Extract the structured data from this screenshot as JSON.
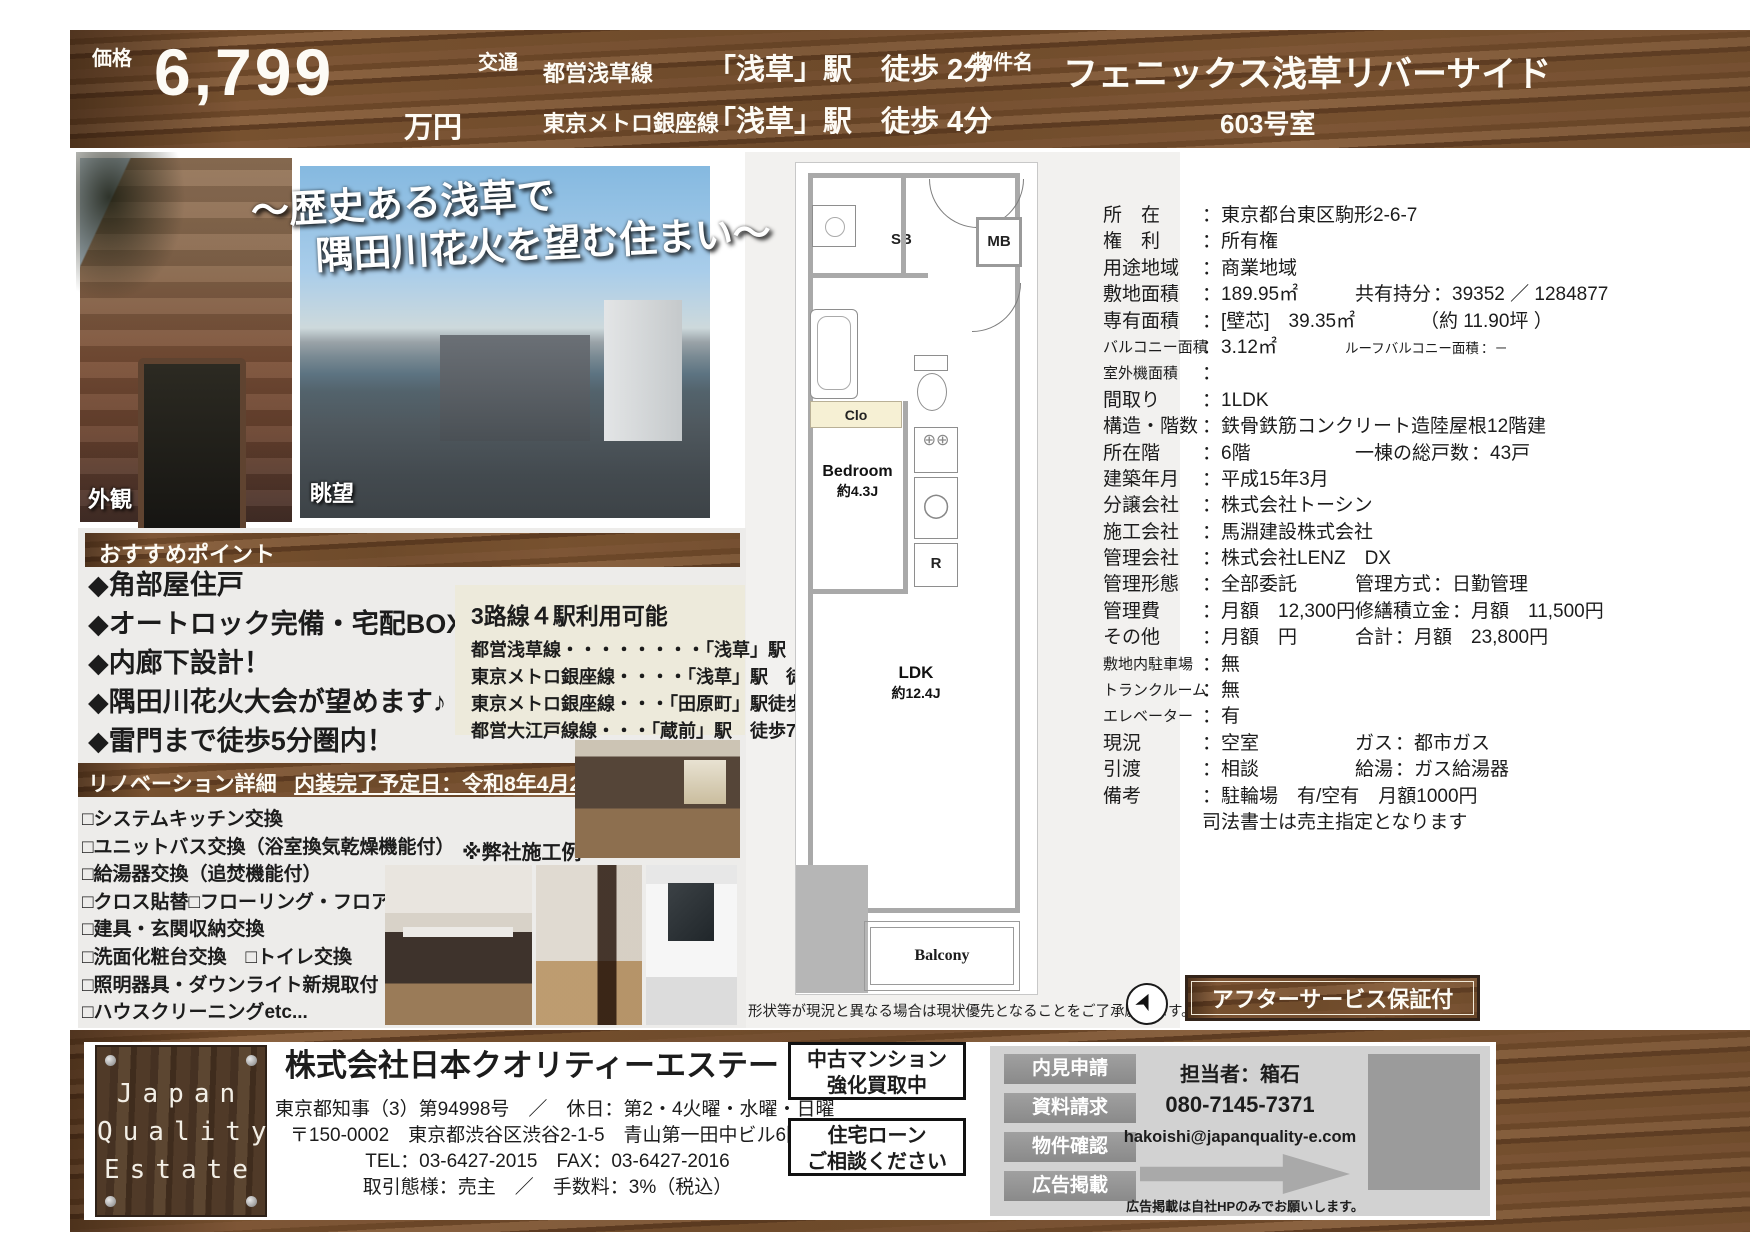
{
  "header": {
    "price_label": "価格",
    "price_value": "6,799",
    "price_unit": "万円",
    "transit_label": "交通",
    "transit": [
      {
        "line": "都営浅草線",
        "dest": "「浅草」駅　徒歩 2分"
      },
      {
        "line": "東京メトロ銀座線",
        "dest": "「浅草」駅　徒歩 4分"
      }
    ],
    "property_label": "物件名",
    "property_name": "フェニックス浅草リバーサイド",
    "room": "603号室"
  },
  "photos": {
    "exterior_label": "外観",
    "view_label": "眺望",
    "catch1": "〜歴史ある浅草で",
    "catch2": "隅田川花火を望む住まい〜"
  },
  "points": {
    "title": "おすすめポイント",
    "items": [
      "◆角部屋住戸",
      "◆オートロック完備・宅配BOX有",
      "◆内廊下設計！",
      "◆隅田川花火大会が望めます♪",
      "◆雷門まで徒歩5分圏内！"
    ]
  },
  "access": {
    "title": "3路線４駅利用可能",
    "items": [
      "都営浅草線・・・・・・・・「浅草」駅　徒歩2分",
      "東京メトロ銀座線・・・・「浅草」駅　徒歩4分",
      "東京メトロ銀座線・・・「田原町」駅徒歩9分",
      "都営大江戸線線・・・「蔵前」駅　徒歩7分"
    ]
  },
  "renovation": {
    "title": "リノベーション詳細",
    "schedule": "内装完了予定日：令和8年4月20日",
    "items": [
      "□システムキッチン交換",
      "□ユニットバス交換（浴室換気乾燥機能付）",
      "□給湯器交換（追焚機能付）",
      "□クロス貼替□フローリング・フロアタイル貼替",
      "□建具・玄関収納交換",
      "□洗面化粧台交換　□トイレ交換",
      "□照明器具・ダウンライト新規取付",
      "□ハウスクリーニングetc..."
    ],
    "example_note": "※弊社施工例"
  },
  "floorplan": {
    "sb": "SB",
    "mb": "MB",
    "clo": "Clo",
    "bedroom": "Bedroom",
    "bedroom_size": "約4.3J",
    "r": "R",
    "stove": "⊕⊕",
    "sink": "◯",
    "ldk": "LDK",
    "ldk_size": "約12.4J",
    "balcony": "Balcony",
    "note": "形状等が現況と異なる場合は現状優先となることをご了承願います。",
    "compass_glyph": "➤"
  },
  "details": {
    "rows": [
      {
        "l": "所　在",
        "v": "：東京都台東区駒形2-6-7"
      },
      {
        "l": "権　利",
        "v": "：所有権"
      },
      {
        "l": "用途地域",
        "v": "：商業地域"
      },
      {
        "l": "敷地面積",
        "v": "：189.95㎡",
        "l2": "共有持分",
        "v2": "：39352 ／ 1284877"
      },
      {
        "l": "専有面積",
        "v": "：[壁芯]　39.35㎡",
        "v2": "（約 11.90坪 ）"
      },
      {
        "l": "バルコニー面積",
        "v": "：3.12㎡",
        "l2": "ルーフバルコニー面積",
        "v2": "：－"
      },
      {
        "l": "室外機面積",
        "v": "："
      },
      {
        "l": "間取り",
        "v": "：1LDK"
      },
      {
        "l": "構造・階数",
        "v": "：鉄骨鉄筋コンクリート造陸屋根12階建"
      },
      {
        "l": "所在階",
        "v": "：6階",
        "l2": "一棟の総戸数",
        "v2": "：43戸"
      },
      {
        "l": "建築年月",
        "v": "：平成15年3月"
      },
      {
        "l": "分譲会社",
        "v": "：株式会社トーシン"
      },
      {
        "l": "施工会社",
        "v": "：馬淵建設株式会社"
      },
      {
        "l": "管理会社",
        "v": "：株式会社LENZ　DX"
      },
      {
        "l": "管理形態",
        "v": "：全部委託",
        "l2": "管理方式",
        "v2": "：日勤管理"
      },
      {
        "l": "管理費",
        "v": "：月額　12,300円",
        "l2": "修繕積立金",
        "v2": "：月額　11,500円"
      },
      {
        "l": "その他",
        "v": "：月額　円",
        "l2": "合計",
        "v2": "：月額　23,800円"
      },
      {
        "l": "敷地内駐車場",
        "v": "：無"
      },
      {
        "l": "トランクルーム",
        "v": "：無"
      },
      {
        "l": "エレベーター",
        "v": "：有"
      },
      {
        "l": "現況",
        "v": "：空室",
        "l2": "ガス",
        "v2": "：都市ガス"
      },
      {
        "l": "引渡",
        "v": "：相談",
        "l2": "給湯",
        "v2": "：ガス給湯器"
      },
      {
        "l": "備考",
        "v": "：駐輪場　有/空有　月額1000円"
      },
      {
        "l": "",
        "v": "司法書士は売主指定となります"
      }
    ]
  },
  "after_service": "アフターサービス保証付",
  "footer": {
    "logo_lines": [
      "Japan",
      "Quality",
      "Estate"
    ],
    "company": "株式会社日本クオリティーエステート",
    "license": "東京都知事（3）第94998号　／　休日：第2・4火曜・水曜・日曜",
    "address": "〒150-0002　東京都渋谷区渋谷2-1-5　青山第一田中ビル6階",
    "tel": "TEL：03-6427-2015　FAX：03-6427-2016",
    "terms": "取引態様：売主　／　手数料：3%（税込）",
    "box1_line1": "中古マンション",
    "box1_line2": "強化買取中",
    "box2_line1": "住宅ローン",
    "box2_line2": "ご相談ください",
    "buttons": [
      "内見申請",
      "資料請求",
      "物件確認",
      "広告掲載"
    ],
    "person": "担当者：箱石",
    "phone": "080-7145-7371",
    "email": "hakoishi@japanquality-e.com",
    "note": "広告掲載は自社HPのみでお願いします。"
  }
}
